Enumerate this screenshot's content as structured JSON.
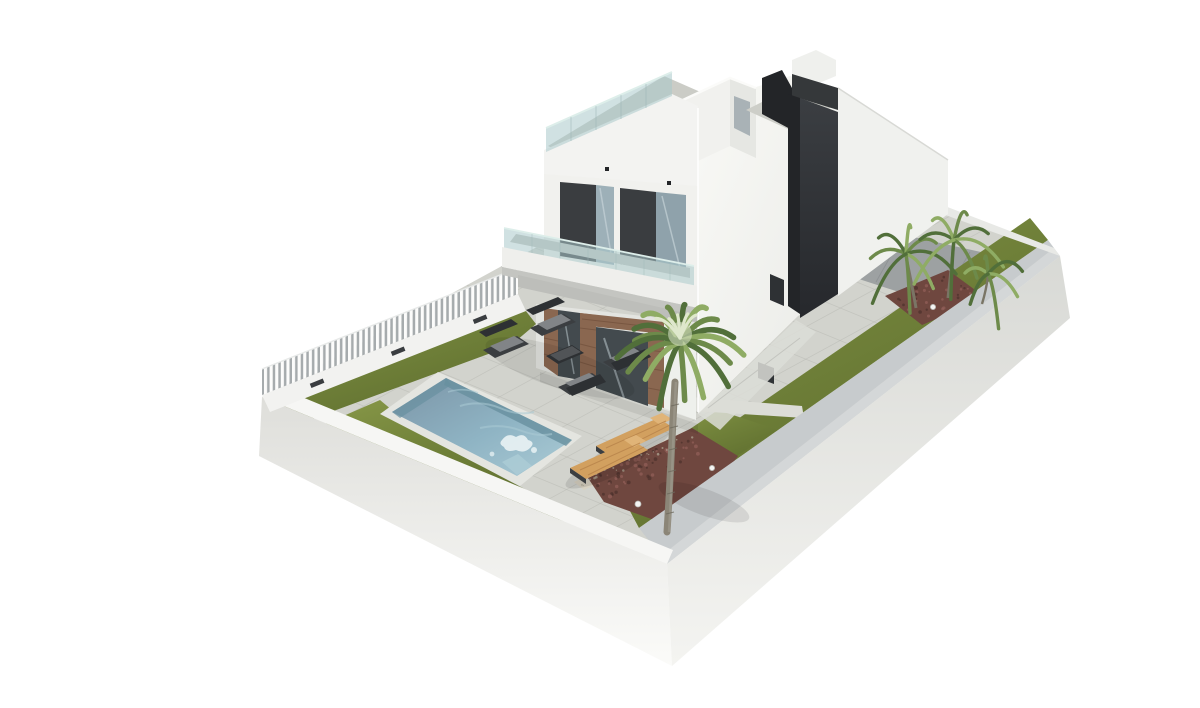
{
  "meta": {
    "width": 1200,
    "height": 676,
    "kind": "3d-architectural-render",
    "view": "aerial three-quarter view",
    "background": "#ffffff"
  },
  "scene": {
    "summary": "Aerial 3D architectural rendering of a modern two-storey white villa with a roof terrace, glass balustrades, a charcoal stair tower, a rectangular swimming pool, pale paved sun deck, lawn panels, a tall palm tree, red-brown mulch planting beds with spotlights, small corner palms, a grey driveway slab and a white perimeter wall with a white slatted fence, on a plain white background.",
    "villa": {
      "storeys": "2 plus roof terrace",
      "style": "modern cubic",
      "features": [
        "frameless glass balustrade on roof terrace",
        "white penthouse volume",
        "charcoal stair-core tower and parapet",
        "first-floor balcony with glass railing",
        "charcoal-framed sliding glass doors",
        "rustic brick pier door surrounds on ground floor",
        "bright white side wall with small window and door opening"
      ]
    },
    "pool": {
      "shape": "rectangular",
      "water": "blue",
      "count": 1
    },
    "furniture": {
      "lounge_armchairs": 4,
      "coffee_table": 1,
      "sun_loungers": 2
    },
    "landscape": {
      "large_palm_trees": 1,
      "small_corner_palms": 3,
      "lawn_panels": 4,
      "mulch_beds": 2,
      "gravel_strips": 2,
      "ground_spotlights": 4,
      "driveway_slab": 1
    },
    "perimeter": {
      "walls": "white rendered walls",
      "fence": "white vertical slatted fence on rear-left boundary",
      "fence_wall_lights": 3
    }
  },
  "palette": {
    "bg": "#ffffff",
    "paving": "#d2d3cd",
    "paving-line": "#b3b4ae",
    "paving-light": "#dcddd7",
    "driveway": "#9da1a2",
    "driveway-line": "#8a8e90",
    "lawn": "#71823a",
    "lawn-dark": "#5c6b2d",
    "lawn-light": "#8a9a49",
    "mulch": "#6f473f",
    "mulch-dark": "#4c302c",
    "mulch-light": "#93605a",
    "gravel": "#d7d1c1",
    "gravel-dot": "#b2ab99",
    "pool-deep": "#7b94a6",
    "pool-mid": "#8fb4c4",
    "pool-light": "#abcbd5",
    "pool-edge": "#68909f",
    "pool-splash": "#eef6f7",
    "coping": "#e4e5e0",
    "wall-top": "#f6f6f4",
    "wall-outer-a": "#dededa",
    "wall-outer-b": "#fbfbf9",
    "wall-inner": "#c7cbcd",
    "fence-slat": "#fcfcfb",
    "fence-gap": "#a6abad",
    "house-white": "#f1f1ee",
    "house-bright": "#f9f9f6",
    "house-shade": "#e6e7e3",
    "fascia": "#f3f3f1",
    "under-shade": "#c4c5c1",
    "gf-wall": "#e3e4e0",
    "charcoal": "#3a3d40",
    "charcoal-dark": "#232528",
    "tower-a": "#3b3e42",
    "tower-b": "#26282c",
    "glass-rail": "rgba(170,200,202,0.55)",
    "glass-edge": "#ddeeea",
    "window-glass": "#9db0b8",
    "window-glass2": "#8fa2ab",
    "door-glass": "#434a4e",
    "reflect": "#c6d3d8",
    "brick": "#8a6750",
    "brick-dark": "#6d4c38",
    "brick-light": "#a5805f",
    "furn": "#3b3e41",
    "furn-dark": "#2d3033",
    "furn-seat": "#818487",
    "wood": "#d2a05f",
    "wood-dark": "#b7834a",
    "trunk": "#8b8577",
    "trunk-dark": "#6e6a5e",
    "frond": "#6d8a4a",
    "frond-dark": "#516f3a",
    "frond-light": "#8fac64",
    "frond-pale": "#dfe8cc",
    "light-dot": "#f4f4f2",
    "shadow": "rgba(0,0,0,0.10)"
  }
}
